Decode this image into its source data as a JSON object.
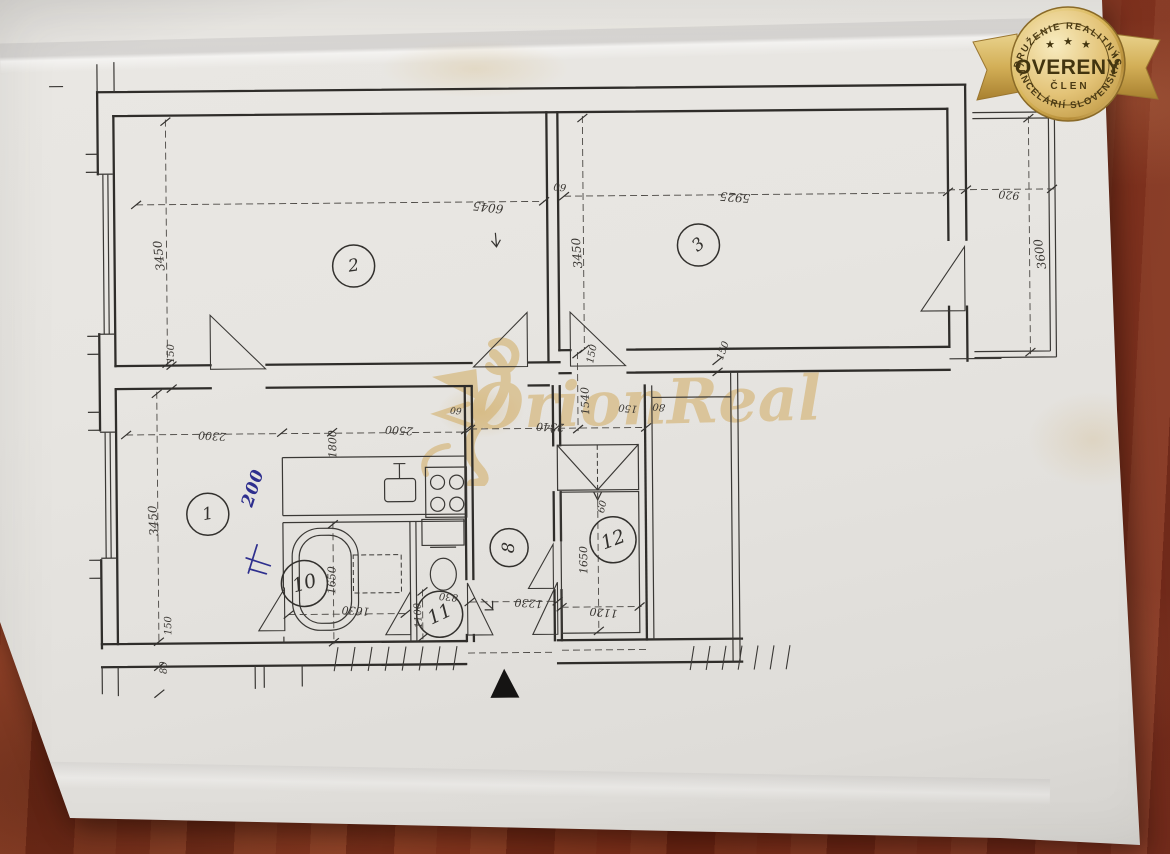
{
  "scene": {
    "wood_color": "#7e3420",
    "paper_color": "#e7e5e1",
    "ink_color": "#2f2d2a",
    "watermark_color": "#d2ac62",
    "note_color": "#2e2f8e"
  },
  "badge": {
    "top_arc": "ZDRUŽENIE REALITNÝCH",
    "stars": [
      "★",
      "★",
      "★"
    ],
    "center": "OVERENÝ",
    "member": "ČLEN",
    "bottom_arc": "KANCELÁRIÍ SLOVENSKA",
    "gold_light": "#f4e4ac",
    "gold_mid": "#d9b659",
    "gold_dark": "#a8802f",
    "text_color": "#4a3a14"
  },
  "watermark": {
    "text": "OrionReal"
  },
  "note": {
    "text": "200"
  },
  "floorplan": {
    "room_labels": [
      {
        "n": "1",
        "x": 207,
        "y": 511,
        "r": 21,
        "rot": -10,
        "fs": 17
      },
      {
        "n": "2",
        "x": 355,
        "y": 264,
        "r": 21,
        "rot": -8,
        "fs": 17
      },
      {
        "n": "3",
        "x": 700,
        "y": 246,
        "r": 21,
        "rot": -38,
        "fs": 17
      },
      {
        "n": "8",
        "x": 508,
        "y": 547,
        "r": 19,
        "rot": -85,
        "fs": 17
      },
      {
        "n": "10",
        "x": 303,
        "y": 581,
        "r": 23,
        "rot": -15,
        "fs": 19
      },
      {
        "n": "11",
        "x": 438,
        "y": 613,
        "r": 23,
        "rot": -25,
        "fs": 19
      },
      {
        "n": "12",
        "x": 612,
        "y": 540,
        "r": 23,
        "rot": -20,
        "fs": 19
      }
    ],
    "dim_labels": [
      {
        "t": "6045",
        "x": 490,
        "y": 206,
        "rot": 187,
        "fs": 12
      },
      {
        "t": "3450",
        "x": 161,
        "y": 252,
        "rot": -96,
        "fs": 12
      },
      {
        "t": "150",
        "x": 172,
        "y": 350,
        "rot": -90,
        "fs": 10
      },
      {
        "t": "60",
        "x": 562,
        "y": 186,
        "rot": 188,
        "fs": 10
      },
      {
        "t": "5925",
        "x": 737,
        "y": 198,
        "rot": 185,
        "fs": 12
      },
      {
        "t": "3450",
        "x": 579,
        "y": 253,
        "rot": -94,
        "fs": 12
      },
      {
        "t": "150",
        "x": 724,
        "y": 352,
        "rot": -70,
        "fs": 10
      },
      {
        "t": "920",
        "x": 1011,
        "y": 198,
        "rot": 185,
        "fs": 11
      },
      {
        "t": "3600",
        "x": 1042,
        "y": 258,
        "rot": -98,
        "fs": 12
      },
      {
        "t": "150",
        "x": 593,
        "y": 354,
        "rot": -78,
        "fs": 10
      },
      {
        "t": "1540",
        "x": 586,
        "y": 401,
        "rot": -91,
        "fs": 11
      },
      {
        "t": "150",
        "x": 628,
        "y": 408,
        "rot": 186,
        "fs": 10
      },
      {
        "t": "80",
        "x": 659,
        "y": 407,
        "rot": 186,
        "fs": 10
      },
      {
        "t": "2340",
        "x": 550,
        "y": 426,
        "rot": 183,
        "fs": 11
      },
      {
        "t": "60",
        "x": 456,
        "y": 409,
        "rot": 186,
        "fs": 9
      },
      {
        "t": "2500",
        "x": 399,
        "y": 428,
        "rot": 184,
        "fs": 11
      },
      {
        "t": "1800",
        "x": 333,
        "y": 442,
        "rot": -90,
        "fs": 11
      },
      {
        "t": "2300",
        "x": 212,
        "y": 432,
        "rot": 184,
        "fs": 11
      },
      {
        "t": "3450",
        "x": 153,
        "y": 517,
        "rot": -93,
        "fs": 12
      },
      {
        "t": "150",
        "x": 167,
        "y": 622,
        "rot": -90,
        "fs": 10
      },
      {
        "t": "80",
        "x": 162,
        "y": 664,
        "rot": -90,
        "fs": 10
      },
      {
        "t": "1650",
        "x": 331,
        "y": 578,
        "rot": -89,
        "fs": 11
      },
      {
        "t": "1630",
        "x": 354,
        "y": 608,
        "rot": 184,
        "fs": 11
      },
      {
        "t": "830",
        "x": 447,
        "y": 595,
        "rot": 186,
        "fs": 10
      },
      {
        "t": "1100",
        "x": 417,
        "y": 614,
        "rot": -93,
        "fs": 10
      },
      {
        "t": "1230",
        "x": 527,
        "y": 602,
        "rot": 184,
        "fs": 11
      },
      {
        "t": "1120",
        "x": 602,
        "y": 612,
        "rot": 185,
        "fs": 11
      },
      {
        "t": "1650",
        "x": 583,
        "y": 560,
        "rot": -90,
        "fs": 11
      },
      {
        "t": "60",
        "x": 602,
        "y": 507,
        "rot": -75,
        "fs": 10
      }
    ]
  }
}
